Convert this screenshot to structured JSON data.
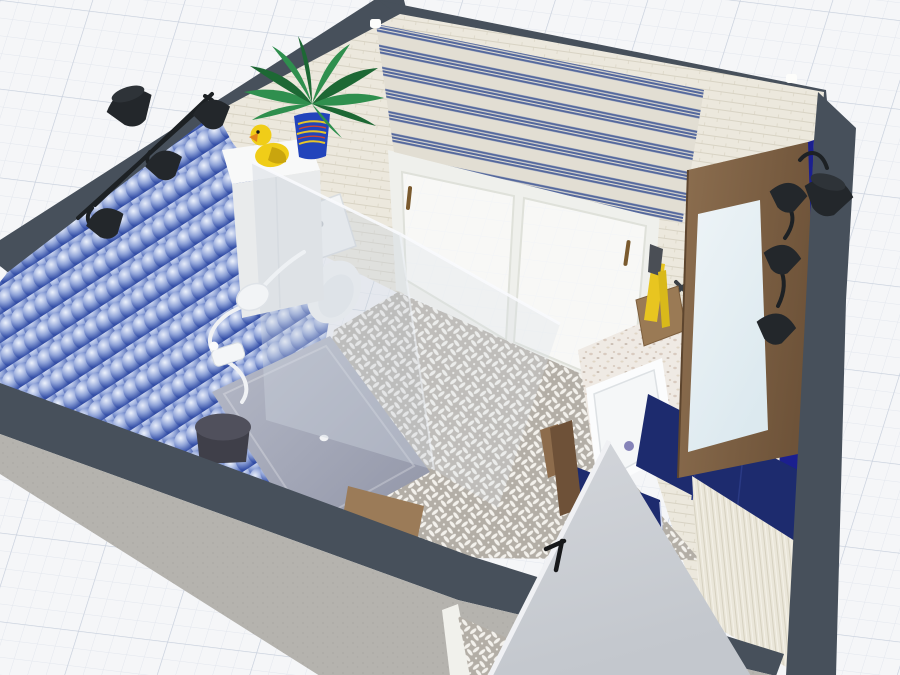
{
  "app": {
    "name": "3D Room Planner Viewport",
    "view_mode": "3D perspective render",
    "scene": "bathroom with cut-away front walls on graph-paper canvas"
  },
  "colors": {
    "canvas_bg": "#f5f6f8",
    "grid_minor": "#e3e7ee",
    "grid_major": "#c7cfdc",
    "wall_top": "#47505b",
    "tile_blue_deep": "#16256b",
    "tile_blue_mid": "#3550a8",
    "tile_blue_light": "#eef3fd",
    "wall_cream": "#ece8dd",
    "wall_cream_line": "#d8d3c4",
    "ridge_cream": "#eae6d9",
    "ridge_line": "#d6d1c0",
    "blind_cream": "#ece8da",
    "blind_blue": "#51679f",
    "floor_gray": "#b3aea6",
    "floor_motif": "#f3f1ec",
    "concrete": "#b5b3ae",
    "navy_cabinet": "#1d2b6e",
    "navy_accent": "#1b1f8f",
    "wood_light": "#8d6f50",
    "wood_dark": "#6e5339",
    "mirror_glass": "#dce9ef",
    "door_gray": "#d3d6db",
    "door_gray_dark": "#c3c7cd",
    "glass_tint": "rgba(205,212,222,0.40)",
    "glass_tint_light": "rgba(218,224,232,0.30)",
    "glass_edge": "rgba(248,250,253,0.9)",
    "tray_light": "#b6bac8",
    "tray_dark": "#9094a6",
    "lamp_black": "#23272b",
    "duck_yellow": "#f0cd18",
    "duck_shade": "#c9a50e",
    "duck_beak": "#e2861c",
    "fern_green": "#2f8f4e",
    "fern_green_dark": "#1d6834",
    "pot_blue": "#2244bb",
    "terrazzo_bg": "#efeae4",
    "porcelain": "#f3f5f6",
    "porcelain_line": "#d9dde0",
    "stool_gray": "#50505c",
    "stool_gray_dark": "#3f3f49",
    "flower_orange": "#e2912a",
    "plant_green": "#6f9a60",
    "barrel_wood": "#7b5838",
    "sink_white": "#fbfcfd",
    "drain_purple": "#8583b8",
    "brass": "#7a5a2e",
    "yellow_brush": "#e8c520"
  },
  "objects": [
    {
      "id": "canvas-grid",
      "label": "graph paper canvas"
    },
    {
      "id": "blue-scale-wall",
      "label": "blue fish-scale tiled wall"
    },
    {
      "id": "striped-blind",
      "label": "blue striped roller blind"
    },
    {
      "id": "window-door",
      "label": "white sliding glass door"
    },
    {
      "id": "fern-plant",
      "label": "fern in blue pot"
    },
    {
      "id": "rubber-duck",
      "label": "yellow rubber duck"
    },
    {
      "id": "toilet",
      "label": "toilet behind glass"
    },
    {
      "id": "shower",
      "label": "walk-in shower with glass screen"
    },
    {
      "id": "shower-stool",
      "label": "dark gray stool"
    },
    {
      "id": "wood-bench",
      "label": "wooden bench"
    },
    {
      "id": "barrel-planter",
      "label": "barrel planter on stand"
    },
    {
      "id": "flower-pot",
      "label": "orange flower pot"
    },
    {
      "id": "vanity",
      "label": "terrazzo vanity with sink"
    },
    {
      "id": "mirror",
      "label": "wood framed mirror"
    },
    {
      "id": "navy-cabinet",
      "label": "navy blue cabinet"
    },
    {
      "id": "sconce-left",
      "label": "black multi-arm wall lamp"
    },
    {
      "id": "sconce-right",
      "label": "black wall lamps"
    },
    {
      "id": "room-door",
      "label": "open door with black handle"
    }
  ]
}
